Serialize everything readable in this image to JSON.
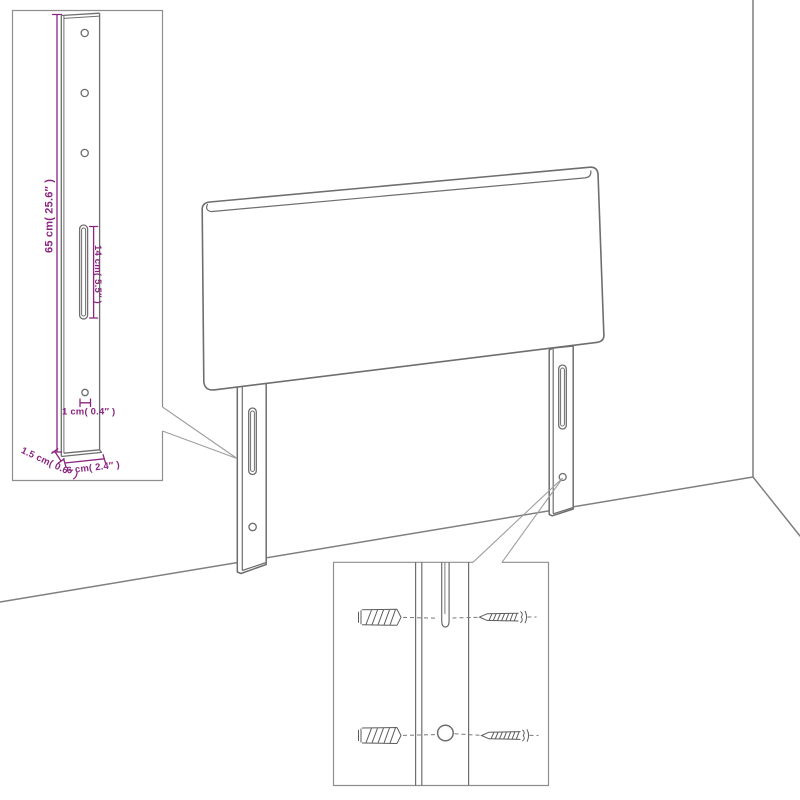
{
  "diagram": {
    "kind": "furniture-assembly-diagram",
    "subject": "headboard with two wall-mount legs, leg detail inset and mounting hardware inset",
    "dimension_labels": {
      "leg_height": "65 cm( 25.6″ )",
      "slot_length": "14 cm( 5.5″ )",
      "hole_diameter": "1 cm( 0.4″ )",
      "leg_thickness": "1.5 cm( 0.6″ )",
      "leg_width": "6 cm( 2.4″ )"
    },
    "icons": [
      "wall-plug-icon",
      "screw-icon",
      "mounting-slot-icon",
      "screw-hole-icon"
    ],
    "colors": {
      "dimension_text": "#8b2680",
      "drawing_outline": "#6e6e6e",
      "inset_border": "#8f8f8f",
      "leader_line": "#9e9e9e",
      "wall_line": "#7f7f7f",
      "background": "#ffffff"
    }
  }
}
